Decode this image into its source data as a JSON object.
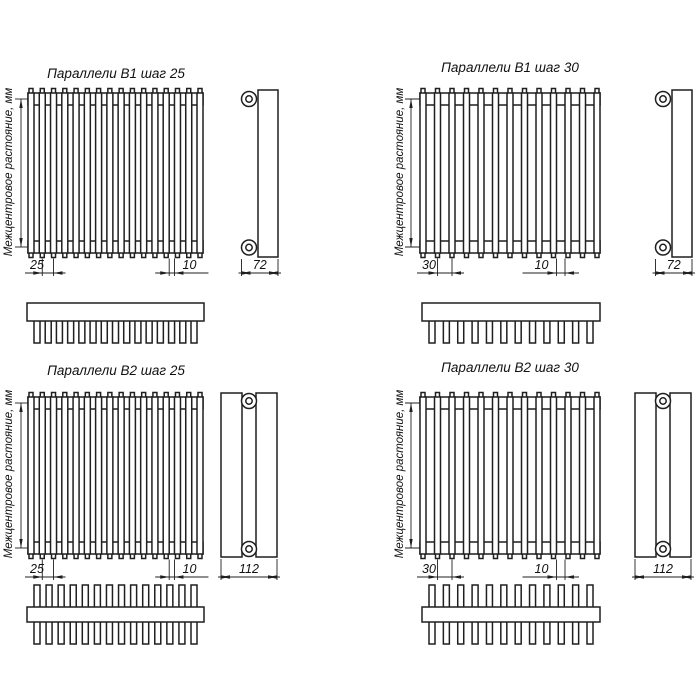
{
  "page": {
    "background": "#ffffff",
    "line_color": "#1f1f1f",
    "text_color": "#111111"
  },
  "quadrants": [
    {
      "id": "b1-step25",
      "title": "Параллели В1 шаг 25",
      "vertical_label": "Межцентровое растояние, мм",
      "radiator_type": "B1",
      "step_mm": "25",
      "tube_gap_mm": "10",
      "depth_mm": "72",
      "front_tube_count": 16,
      "top_view_teeth": 15,
      "double_row": false
    },
    {
      "id": "b1-step30",
      "title": "Параллели В1 шаг 30",
      "vertical_label": "Межцентровое растояние, мм",
      "radiator_type": "B1",
      "step_mm": "30",
      "tube_gap_mm": "10",
      "depth_mm": "72",
      "front_tube_count": 13,
      "top_view_teeth": 12,
      "double_row": false
    },
    {
      "id": "b2-step25",
      "title": "Параллели В2 шаг 25",
      "vertical_label": "Межцентровое растояние, мм",
      "radiator_type": "B2",
      "step_mm": "25",
      "tube_gap_mm": "10",
      "depth_mm": "112",
      "front_tube_count": 16,
      "top_view_teeth": 14,
      "double_row": true
    },
    {
      "id": "b2-step30",
      "title": "Параллели В2 шаг 30",
      "vertical_label": "Межцентровое растояние, мм",
      "radiator_type": "B2",
      "step_mm": "30",
      "tube_gap_mm": "10",
      "depth_mm": "112",
      "front_tube_count": 13,
      "top_view_teeth": 12,
      "double_row": true
    }
  ]
}
